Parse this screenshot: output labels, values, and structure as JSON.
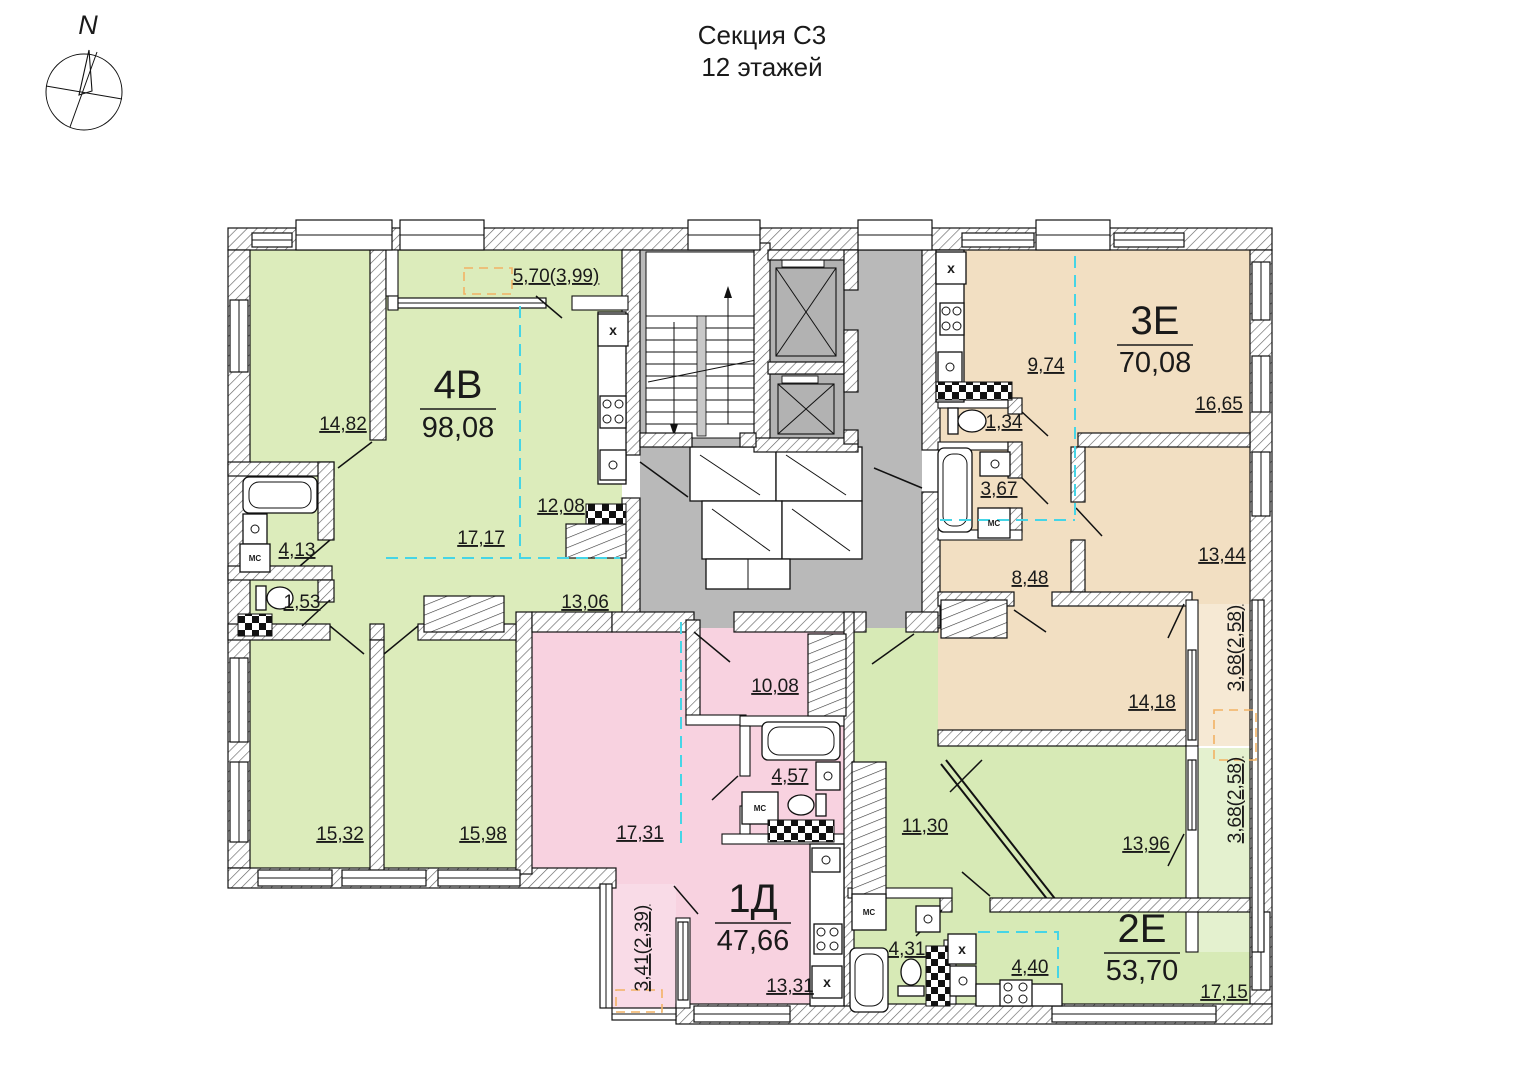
{
  "title": {
    "section": "Секция С3",
    "floors": "12 этажей"
  },
  "compass": {
    "north": "N"
  },
  "colors": {
    "apartment_4v": "#dcecbb",
    "apartment_3e": "#f2dfc2",
    "apartment_1d": "#f8d2e0",
    "apartment_2e": "#d7eab6",
    "common_area": "#b9b9b9"
  },
  "apartments": [
    {
      "code": "4В",
      "total_area": "98,08",
      "balcony_area": "5,70(3,99)",
      "rooms": [
        {
          "area": "14,82"
        },
        {
          "area": "17,17"
        },
        {
          "area": "12,08"
        },
        {
          "area": "13,06"
        },
        {
          "area": "4,13"
        },
        {
          "area": "1,53"
        },
        {
          "area": "15,32"
        },
        {
          "area": "15,98"
        }
      ]
    },
    {
      "code": "3Е",
      "total_area": "70,08",
      "balcony_area": "3,68(2,58)",
      "rooms": [
        {
          "area": "9,74"
        },
        {
          "area": "16,65"
        },
        {
          "area": "13,44"
        },
        {
          "area": "14,18"
        },
        {
          "area": "8,48"
        },
        {
          "area": "1,34"
        },
        {
          "area": "3,67"
        }
      ]
    },
    {
      "code": "1Д",
      "total_area": "47,66",
      "balcony_area": "3,41(2,39)",
      "rooms": [
        {
          "area": "10,08"
        },
        {
          "area": "17,31"
        },
        {
          "area": "4,57"
        },
        {
          "area": "13,31"
        }
      ]
    },
    {
      "code": "2Е",
      "total_area": "53,70",
      "balcony_area": "3,68(2,58)",
      "rooms": [
        {
          "area": "11,30"
        },
        {
          "area": "13,96"
        },
        {
          "area": "4,31"
        },
        {
          "area": "4,40"
        },
        {
          "area": "17,15"
        }
      ]
    }
  ],
  "annotations": {
    "washing_machine": "МС",
    "vent_duct": "х"
  }
}
